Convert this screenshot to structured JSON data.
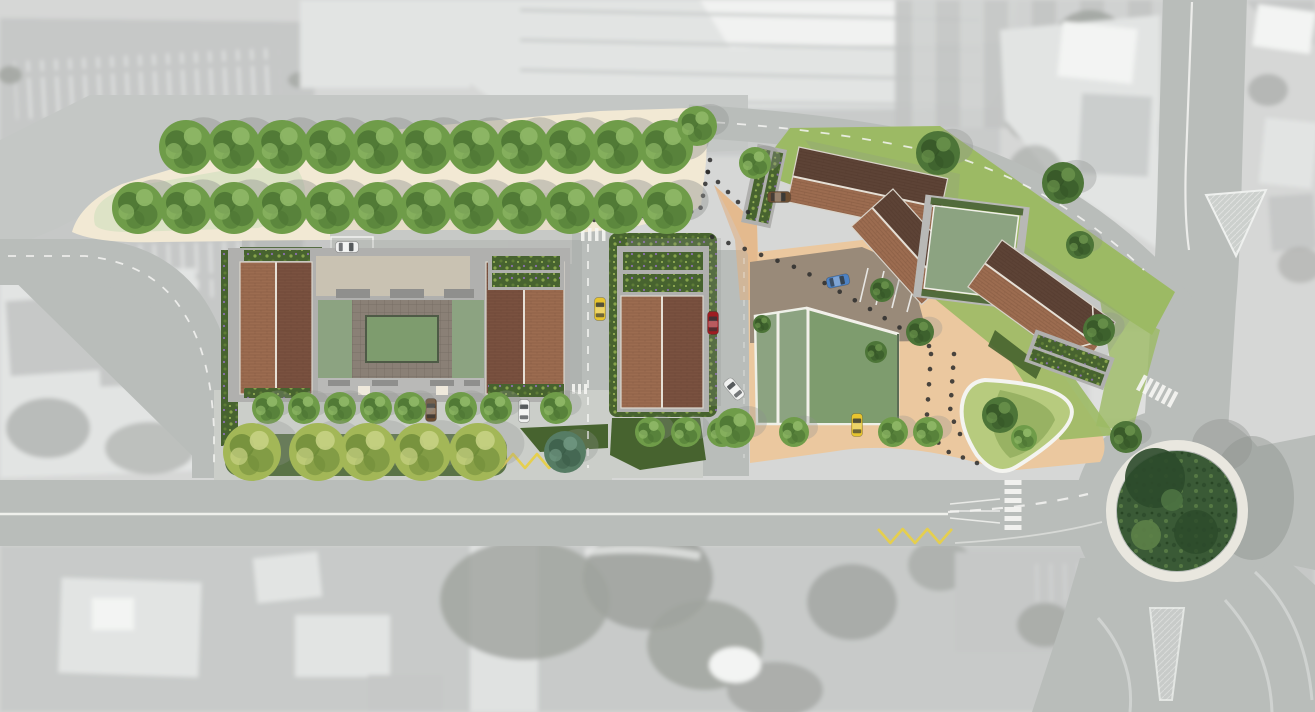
{
  "scene": {
    "kind": "architectural-masterplan-site-plan",
    "view": "aerial-top-down",
    "canvas": {
      "width": 1315,
      "height": 712
    }
  },
  "palette": {
    "aerial_base": "#d6d7d6",
    "aerial_mid": "#c6c8c7",
    "aerial_light": "#e2e4e3",
    "aerial_white": "#f3f4f3",
    "aerial_dark": "#9fa29e",
    "plan_road": "#b9bdba",
    "apron": "#c4c7c5",
    "sidewalk": "#cbcec9",
    "plaza": "#f2e9d4",
    "plaza_lawn": "#dde3c6",
    "gravel": "#e4dbc6",
    "tan": "#ebc89f",
    "tan_deep": "#dfb083",
    "shared": "#998a79",
    "grass": "#9cba64",
    "hedge": "#47632f",
    "veg_light": "#86a34b",
    "veg_flower": "#8a6fae",
    "brick_light": "#9c6c50",
    "brick_dark": "#5d4336",
    "brick_shade": "#7a5240",
    "frame_gray": "#b0b0ae",
    "frame_dark": "#8f8f8d",
    "beige_roof": "#c9c2b2",
    "sage": "#8ca381",
    "sage_panel": "#7e9c6e",
    "terrace": "#8a8076",
    "walk": "#b9b9b7",
    "island_base": "#3a5a36",
    "island_dark": "#2c4a2b",
    "island_light": "#5d8148",
    "ring": "#e9e7df",
    "marking": "#f5f5f2",
    "zigzag": "#e5cf4e",
    "bollard": "#2b2b2b",
    "shadow": "#8f928f",
    "car_window": "#2f3437"
  },
  "tree_variants": {
    "mid": {
      "base": "#6f9c49",
      "dark": "#4a7232",
      "light": "#8fb867"
    },
    "dark": {
      "base": "#4d7538",
      "dark": "#345426",
      "light": "#68904a"
    },
    "yellow": {
      "base": "#a3b757",
      "dark": "#6d8a38",
      "light": "#c7d284"
    },
    "teal": {
      "base": "#567c64",
      "dark": "#3b5c48",
      "light": "#6f9680"
    }
  },
  "trees": [
    {
      "variant": "mid",
      "r": 27,
      "y": 147,
      "shadow": 0.42,
      "xs": [
        186,
        234,
        282,
        330,
        378,
        426,
        474,
        522,
        570,
        618,
        666
      ]
    },
    {
      "variant": "mid",
      "r": 26,
      "y": 208,
      "shadow": 0.42,
      "xs": [
        138,
        186,
        234,
        282,
        330,
        378,
        426,
        474,
        522,
        570,
        618,
        667
      ]
    },
    {
      "variant": "mid",
      "r": 16,
      "y": 408,
      "shadow": 0.3,
      "xs": [
        268,
        304,
        340,
        376,
        410,
        461,
        496,
        556
      ]
    },
    {
      "variant": "yellow",
      "r": 29,
      "y": 452,
      "shadow": 0.28,
      "xs": [
        252,
        318,
        368,
        422,
        478
      ]
    },
    {
      "variant": "mid",
      "r": 15,
      "y": 432,
      "shadow": 0.3,
      "xs": [
        650,
        686,
        722,
        794,
        893,
        928
      ]
    },
    {
      "variant": "mid",
      "r": 20,
      "y": 428,
      "shadow": 0.3,
      "xs": [
        735
      ]
    },
    {
      "variant": "teal",
      "r": 21,
      "y": 452,
      "shadow": 0.3,
      "xs": [
        565
      ]
    },
    {
      "variant": "mid",
      "r": 20,
      "y": 126,
      "shadow": 0.35,
      "xs": [
        697
      ]
    },
    {
      "variant": "mid",
      "r": 16,
      "y": 163,
      "shadow": 0.35,
      "xs": [
        755
      ]
    },
    {
      "variant": "dark",
      "r": 22,
      "y": 153,
      "shadow": 0.35,
      "xs": [
        938
      ]
    },
    {
      "variant": "dark",
      "r": 21,
      "y": 183,
      "shadow": 0.35,
      "xs": [
        1063
      ]
    },
    {
      "variant": "dark",
      "r": 14,
      "y": 245,
      "shadow": 0.3,
      "xs": [
        1080
      ]
    },
    {
      "variant": "dark",
      "r": 14,
      "y": 332,
      "shadow": 0.3,
      "xs": [
        920
      ]
    },
    {
      "variant": "dark",
      "r": 16,
      "y": 330,
      "shadow": 0.3,
      "xs": [
        1099
      ]
    },
    {
      "variant": "dark",
      "r": 16,
      "y": 437,
      "shadow": 0.3,
      "xs": [
        1126
      ]
    },
    {
      "variant": "dark",
      "r": 12,
      "y": 290,
      "shadow": 0.25,
      "xs": [
        882
      ]
    },
    {
      "variant": "dark",
      "r": 18,
      "y": 415,
      "shadow": 0.0,
      "xs": [
        1000
      ]
    },
    {
      "variant": "mid",
      "r": 13,
      "y": 438,
      "shadow": 0.0,
      "xs": [
        1024
      ]
    },
    {
      "variant": "dark",
      "r": 9,
      "y": 324,
      "shadow": 0.0,
      "xs": [
        762
      ]
    },
    {
      "variant": "dark",
      "r": 11,
      "y": 352,
      "shadow": 0.0,
      "xs": [
        876
      ]
    }
  ],
  "cars": [
    {
      "x": 347,
      "y": 247,
      "angle": 90,
      "color": "#f0f1f0",
      "name": "parked-white-van-plaza"
    },
    {
      "x": 600,
      "y": 309,
      "angle": 0,
      "color": "#e7c42e",
      "name": "yellow-car-internal-street"
    },
    {
      "x": 713,
      "y": 323,
      "angle": 0,
      "color": "#9e1d22",
      "name": "red-car-parking-lane"
    },
    {
      "x": 734,
      "y": 389,
      "angle": -40,
      "color": "#f0f1f0",
      "name": "white-car-turning"
    },
    {
      "x": 838,
      "y": 281,
      "angle": 78,
      "color": "#4d82c4",
      "name": "blue-car-shared-court"
    },
    {
      "x": 857,
      "y": 425,
      "angle": 0,
      "color": "#e7c42e",
      "name": "yellow-car-south-bay"
    },
    {
      "x": 431,
      "y": 410,
      "angle": 0,
      "color": "#6e4f33",
      "name": "brown-car-street-bay"
    },
    {
      "x": 524,
      "y": 411,
      "angle": 0,
      "color": "#f0f1f0",
      "name": "white-car-street-bay"
    },
    {
      "x": 779,
      "y": 197,
      "angle": 90,
      "color": "#6e4f33",
      "name": "brown-car-north-drive"
    }
  ],
  "bollard_lines": [
    {
      "points": [
        [
          570,
          222
        ],
        [
          700,
          211
        ],
        [
          710,
          160
        ]
      ],
      "count": 16
    },
    {
      "points": [
        [
          708,
          172
        ],
        [
          748,
          212
        ]
      ],
      "count": 5
    },
    {
      "points": [
        [
          712,
          237
        ],
        [
          800,
          269
        ],
        [
          870,
          309
        ],
        [
          929,
          346
        ]
      ],
      "count": 15
    },
    {
      "points": [
        [
          931,
          354
        ],
        [
          927,
          415
        ],
        [
          941,
          449
        ],
        [
          977,
          463
        ]
      ],
      "count": 10
    },
    {
      "points": [
        [
          954,
          354
        ],
        [
          950,
          414
        ],
        [
          960,
          434
        ]
      ],
      "count": 7
    }
  ],
  "zigzags": [
    {
      "x": 489,
      "y": 461,
      "len": 84,
      "teeth": 7,
      "amp": 7
    },
    {
      "x": 878,
      "y": 536,
      "len": 74,
      "teeth": 6,
      "amp": 7
    }
  ],
  "crossings": [
    {
      "x": 1013,
      "y": 480,
      "angle": 0,
      "count": 6,
      "w": 17,
      "h": 5,
      "pitch": 9
    },
    {
      "x": 1140,
      "y": 382,
      "angle": -62,
      "count": 6,
      "w": 17,
      "h": 4,
      "pitch": 7
    }
  ],
  "stripe_marks": [
    {
      "x": 581,
      "y": 228,
      "count": 4,
      "w": 3.5,
      "h": 13,
      "pitch": 7
    },
    {
      "x": 572,
      "y": 384,
      "count": 3,
      "w": 3,
      "h": 10,
      "pitch": 6
    }
  ]
}
